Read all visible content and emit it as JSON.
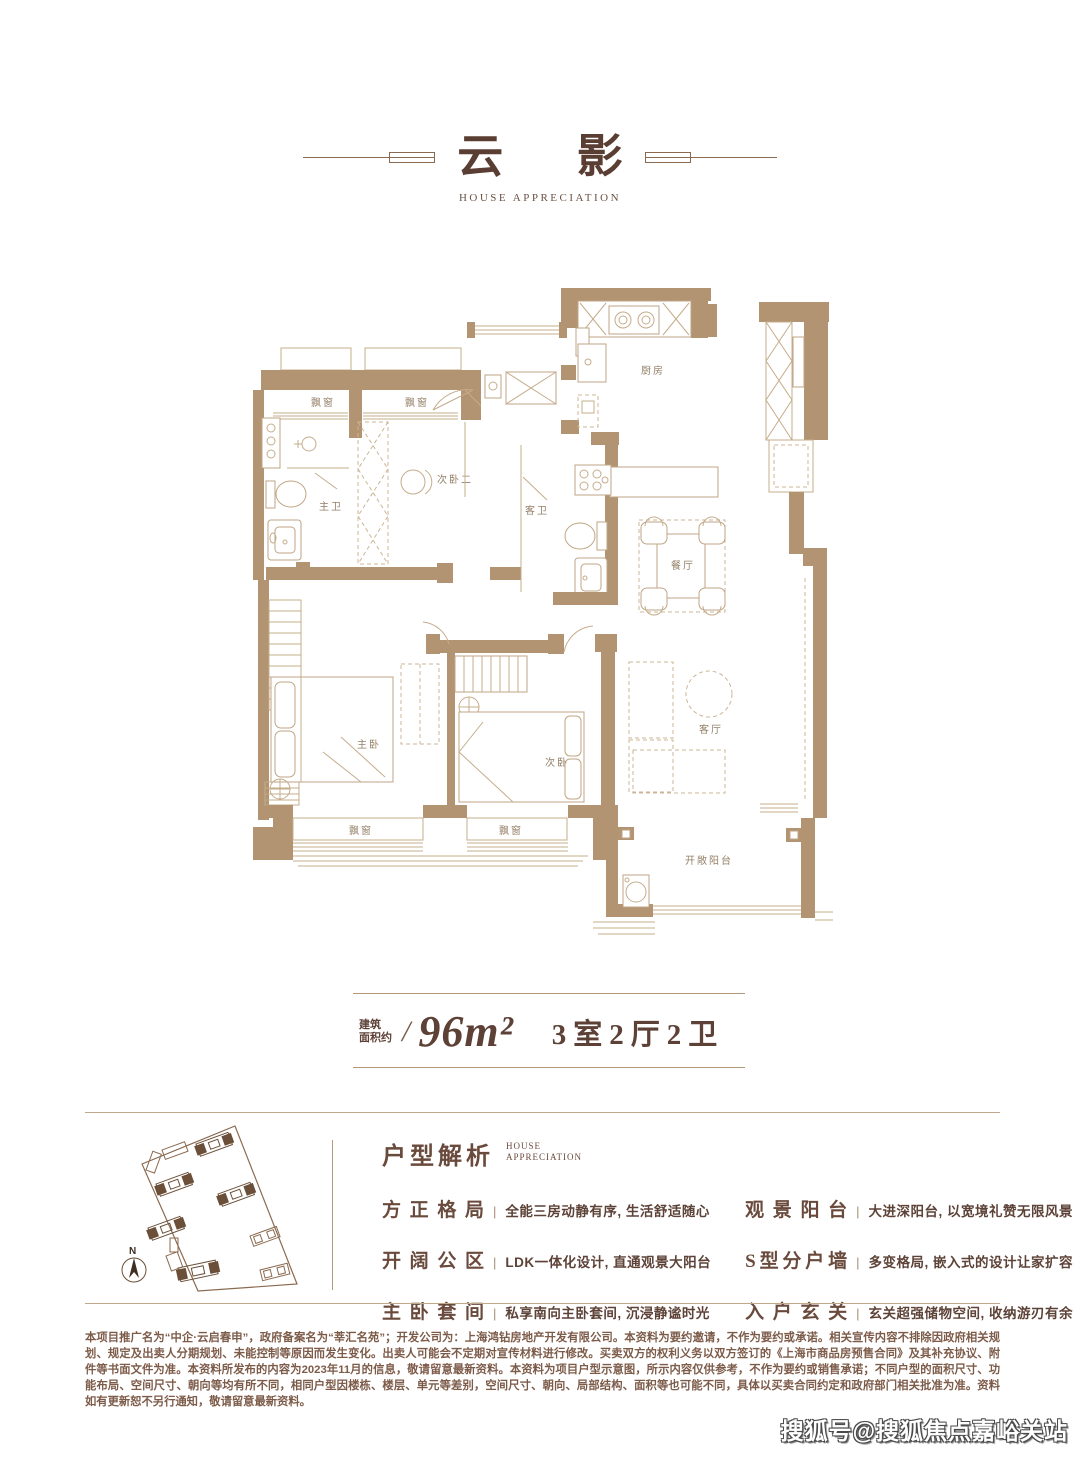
{
  "page": {
    "title": "云影",
    "subtitle": "HOUSE APPRECIATION"
  },
  "floor_plan": {
    "rooms": {
      "kitchen": "厨房",
      "dining": "餐厅",
      "living": "客厅",
      "master_bed": "主卧",
      "second_bed": "次卧",
      "second_bed2": "次卧二",
      "master_bath": "主卫",
      "guest_bath": "客卫",
      "balcony": "开敞阳台",
      "bay_window": "飘窗"
    },
    "compass_label": "N"
  },
  "area_info": {
    "prefix_line1": "建筑",
    "prefix_line2": "面积约",
    "separator": "/",
    "area": "96m²",
    "layout": "3室2厅2卫"
  },
  "analysis": {
    "heading": "户型解析",
    "heading_en_line1": "HOUSE",
    "heading_en_line2": "APPRECIATION",
    "separator": "|",
    "items_left": [
      {
        "term": "方正格局",
        "desc": "全能三房动静有序, 生活舒适随心"
      },
      {
        "term": "开阔公区",
        "desc": "LDK一体化设计, 直通观景大阳台"
      },
      {
        "term": "主卧套间",
        "desc": "私享南向主卧套间, 沉浸静谧时光"
      }
    ],
    "items_right": [
      {
        "term": "观景阳台",
        "desc": "大进深阳台, 以宽境礼赞无限风景"
      },
      {
        "term": "S型分户墙",
        "desc": "多变格局, 嵌入式的设计让家扩容"
      },
      {
        "term": "入户玄关",
        "desc": "玄关超强储物空间, 收纳游刃有余"
      }
    ]
  },
  "disclaimer": "本项目推广名为“中企·云启春申”，政府备案名为“莘汇名苑”；开发公司为：上海鸿钻房地产开发有限公司。本资料为要约邀请，不作为要约或承诺。相关宣传内容不排除因政府相关规划、规定及出卖人分期规划、未能控制等原因而发生变化。出卖人可能会不定期对宣传材料进行修改。买卖双方的权利义务以双方签订的《上海市商品房预售合同》及其补充协议、附件等书面文件为准。本资料所发布的内容为2023年11月的信息，敬请留意最新资料。本资料为项目户型示意图，所示内容仅供参考，不作为要约或销售承诺；不同户型的面积尺寸、功能布局、空间尺寸、朝向等均有所不同，相同户型因楼栋、楼层、单元等差别，空间尺寸、朝向、局部结构、面积等也可能不同，具体以买卖合同约定和政府部门相关批准为准。资料如有更新恕不另行通知，敬请留意最新资料。",
  "watermark": "搜狐号@搜狐焦点嘉峪关站",
  "colors": {
    "wall": "#b29472",
    "thin_line": "#c5ac8b",
    "accent_dark": "#5a3e33",
    "text_brown": "#7d5b49",
    "plan_label": "#937f66"
  }
}
